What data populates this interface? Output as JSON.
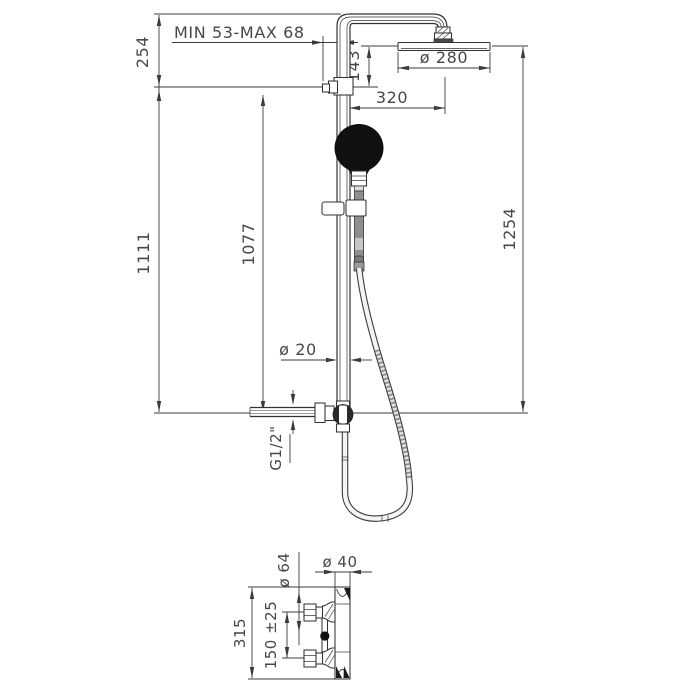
{
  "dim": {
    "adjust_range": "MIN 53-MAX 68",
    "top_to_bracket": "254",
    "bracket_to_head": "143",
    "head_diameter": "ø 280",
    "arm_projection": "320",
    "overall_height": "1254",
    "column_height": "1111",
    "rail_height": "1077",
    "column_diameter": "ø 20",
    "inlet_thread": "G1/2\"",
    "detail_escutcheon_diameter": "ø 64",
    "detail_body_diameter": "ø 40",
    "detail_inlet_spacing": "150 ±25",
    "detail_height": "315"
  },
  "colors": {
    "background": "#ffffff",
    "line": "#3b3b3b",
    "text": "#474747",
    "handset_fill": "#101010",
    "handle_gray": "#8f8f8f"
  }
}
